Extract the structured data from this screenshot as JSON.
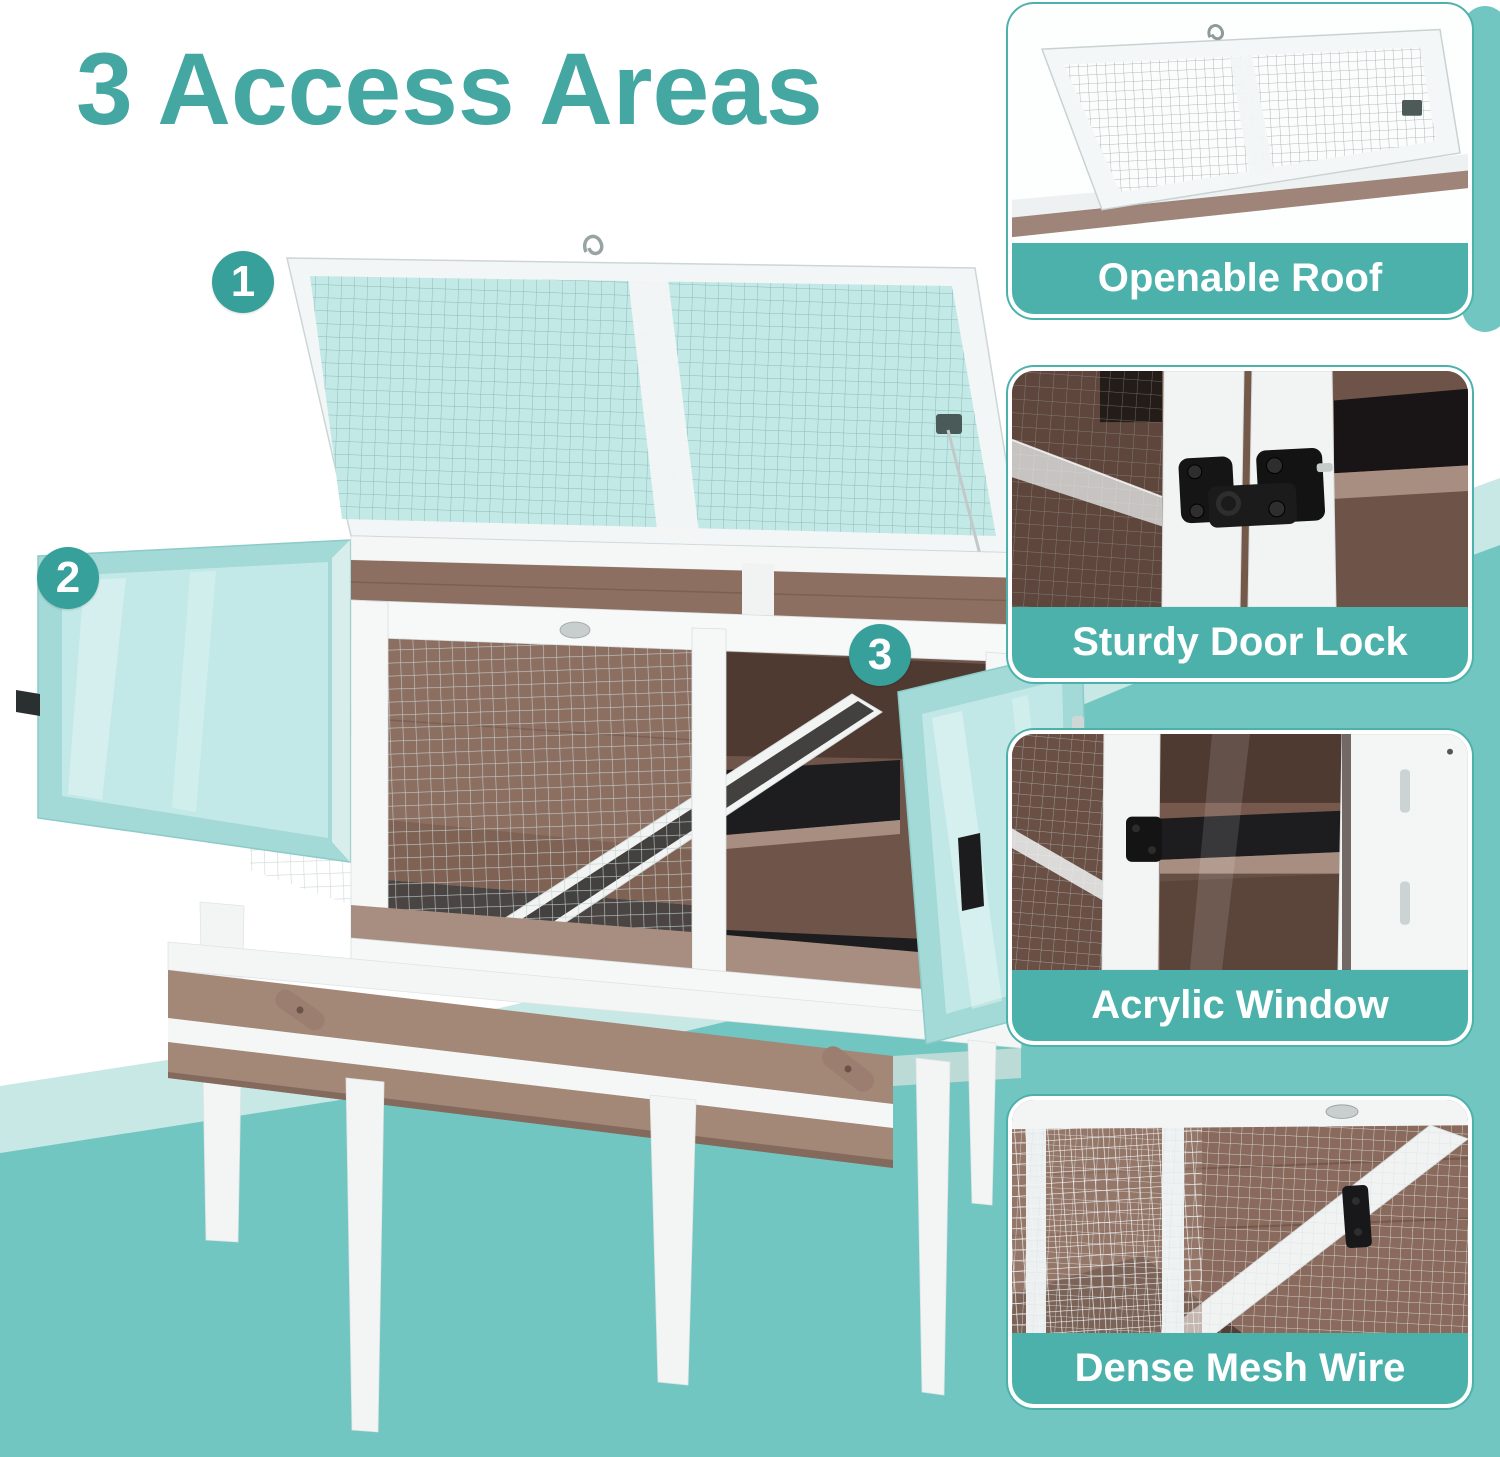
{
  "title": "3 Access Areas",
  "markers": [
    {
      "number": "1"
    },
    {
      "number": "2"
    },
    {
      "number": "3"
    }
  ],
  "panels": [
    {
      "caption": "Openable Roof"
    },
    {
      "caption": "Sturdy Door Lock"
    },
    {
      "caption": "Acrylic Window"
    },
    {
      "caption": "Dense Mesh Wire"
    }
  ],
  "colors": {
    "title": "#45a7a2",
    "badge": "#37a09b",
    "capbar": "#4db1ab",
    "caption_text": "#ffffff",
    "bg_teal": "#72c6c1",
    "bg_teal_light": "#c7e8e5",
    "aqua": "#c3e9e7",
    "aqua_frame": "#a3d9d6",
    "wood": "#8d6f62",
    "wood_dark": "#745849",
    "wood_light": "#a88e80",
    "tray": "#a38878",
    "ink": "#1d1c1e",
    "mesh": "#c3cecd",
    "white_frame": "#f5f7f7"
  }
}
